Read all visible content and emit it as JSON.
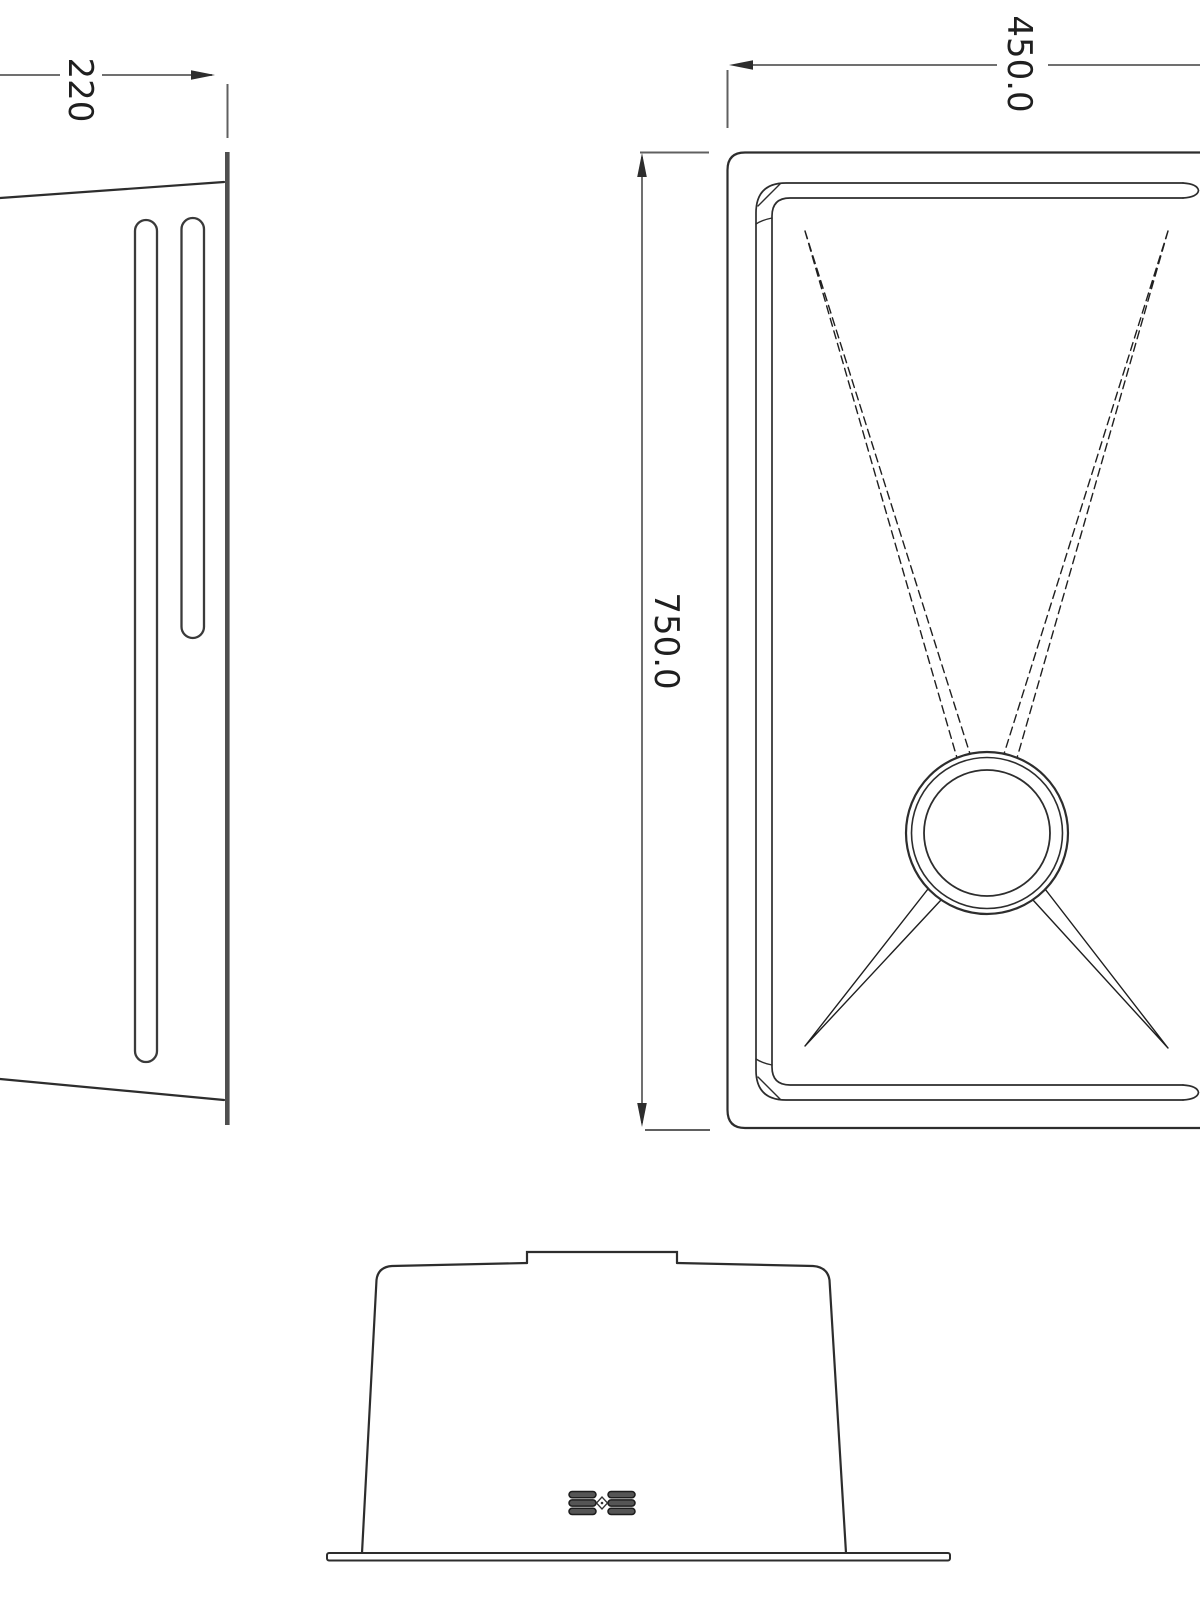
{
  "dimensions": {
    "side_depth": "220",
    "plan_width": "450.0",
    "plan_length": "750.0"
  },
  "icons": {
    "brand_logo": "stacked-bars-diamond-mark"
  },
  "colors": {
    "background": "#ffffff",
    "line": "#2d2d2d",
    "thick_line": "#4f4f4f",
    "dimension_line": "#707070",
    "text": "#1f1f1f"
  }
}
